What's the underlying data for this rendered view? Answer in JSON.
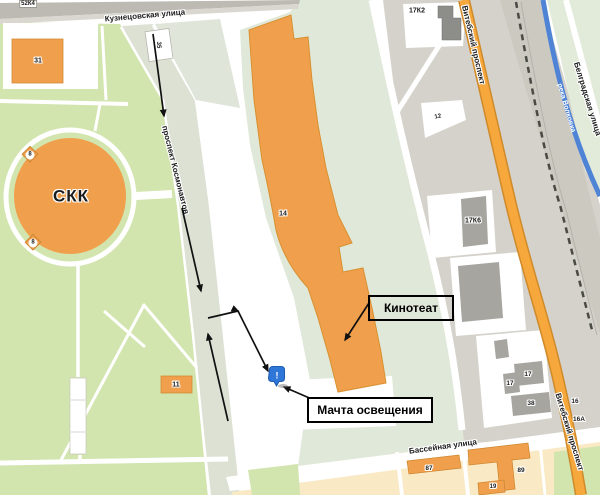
{
  "map": {
    "streets": {
      "kuznetsovskaya": "Кузнецовская улица",
      "kosmonavtov": "проспект Космонавтов",
      "vitebsky_top": "Витебский проспект",
      "vitebsky_bottom": "Витебский проспект",
      "belgradskaya": "Белградская улица",
      "basseynaya": "Бассейная улица",
      "river": "река Волковка"
    },
    "landmark": {
      "skk": "СКК"
    },
    "callouts": {
      "cinema": "Кинотеат",
      "mast": "Мачта освещения"
    },
    "buildings": {
      "b52k4": "52К4",
      "b31": "31",
      "b35": "35",
      "b8a": "8",
      "b8b": "8",
      "b14": "14",
      "b11": "11",
      "b17k2": "17К2",
      "b12": "12",
      "b17k6": "17К6",
      "b17a": "17",
      "b17b": "17",
      "b38": "38",
      "b16": "16",
      "b16a": "16А",
      "b87": "87",
      "b89": "89",
      "b19": "19"
    },
    "marker": {
      "glyph": "!"
    },
    "colors": {
      "park": "#d2e5ae",
      "sage": "#e0e8d9",
      "building_orange": "#f0a04c",
      "road_major": "#f7a83c",
      "road_casing": "#cf8a2a",
      "river": "#4f83d6",
      "urban_gray": "#d4d2ca",
      "building_gray": "#a6a5a0",
      "rail": "#4a4a44",
      "residential": "#f9e9c4",
      "marker_blue": "#2e76d8",
      "arrow": "#111111"
    }
  }
}
